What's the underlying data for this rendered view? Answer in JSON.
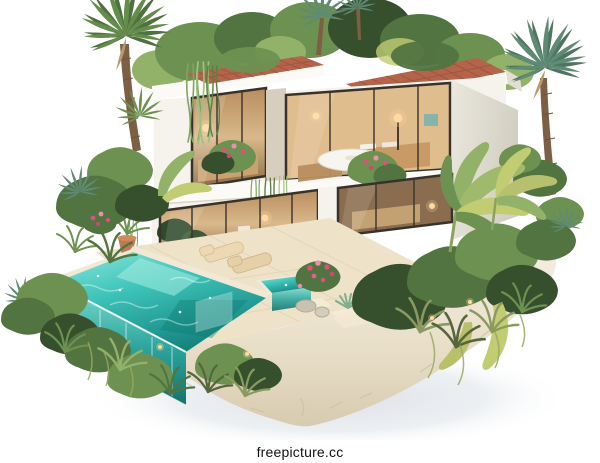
{
  "image": {
    "type": "3d-architectural-render",
    "subject": "Modern two-story tropical villa with rooftop garden and glass infinity pool on a floating rock island",
    "style": "isometric, white studio background"
  },
  "watermark": {
    "text": "freepicture.cc"
  },
  "scene": {
    "elements": [
      "rooftop-garden",
      "terracotta-tile-roof",
      "upper-floor-glass-bedrooms",
      "terrace-dining-table",
      "flower-planters",
      "hanging-vines",
      "ground-floor-glass-living-room",
      "infinity-glass-pool",
      "spa-pool",
      "pool-deck",
      "sun-loungers",
      "terracotta-pot",
      "palm-tree-left",
      "palm-tree-right",
      "banana-plants",
      "bougainvillea",
      "rock-island-base",
      "garden-lights"
    ]
  },
  "colors": {
    "background": "#ffffff",
    "shadow": "#dfe3e7",
    "poolLight": "#8ce8dc",
    "pool": "#3cc2b8",
    "poolDeep": "#15847f",
    "deck": "#eee2c9",
    "wall": "#f6f3ec",
    "fascia": "#fbfaf6",
    "frame": "#38322b",
    "roofTile": "#b4644a",
    "roofLine": "#8c4936",
    "interior": "#d9b98b",
    "glow": "#ffd9a0",
    "greenDark": "#36502e",
    "green": "#527441",
    "greenMid": "#6d9150",
    "greenLight": "#93b269",
    "greenYellow": "#c2cc72",
    "pink": "#d9537b",
    "trunk": "#7d5f45",
    "palmBlue": "#5f8a74",
    "rock": "#e9e0cc",
    "stone": "#c9c2b2",
    "watermarkText": "#111111"
  }
}
